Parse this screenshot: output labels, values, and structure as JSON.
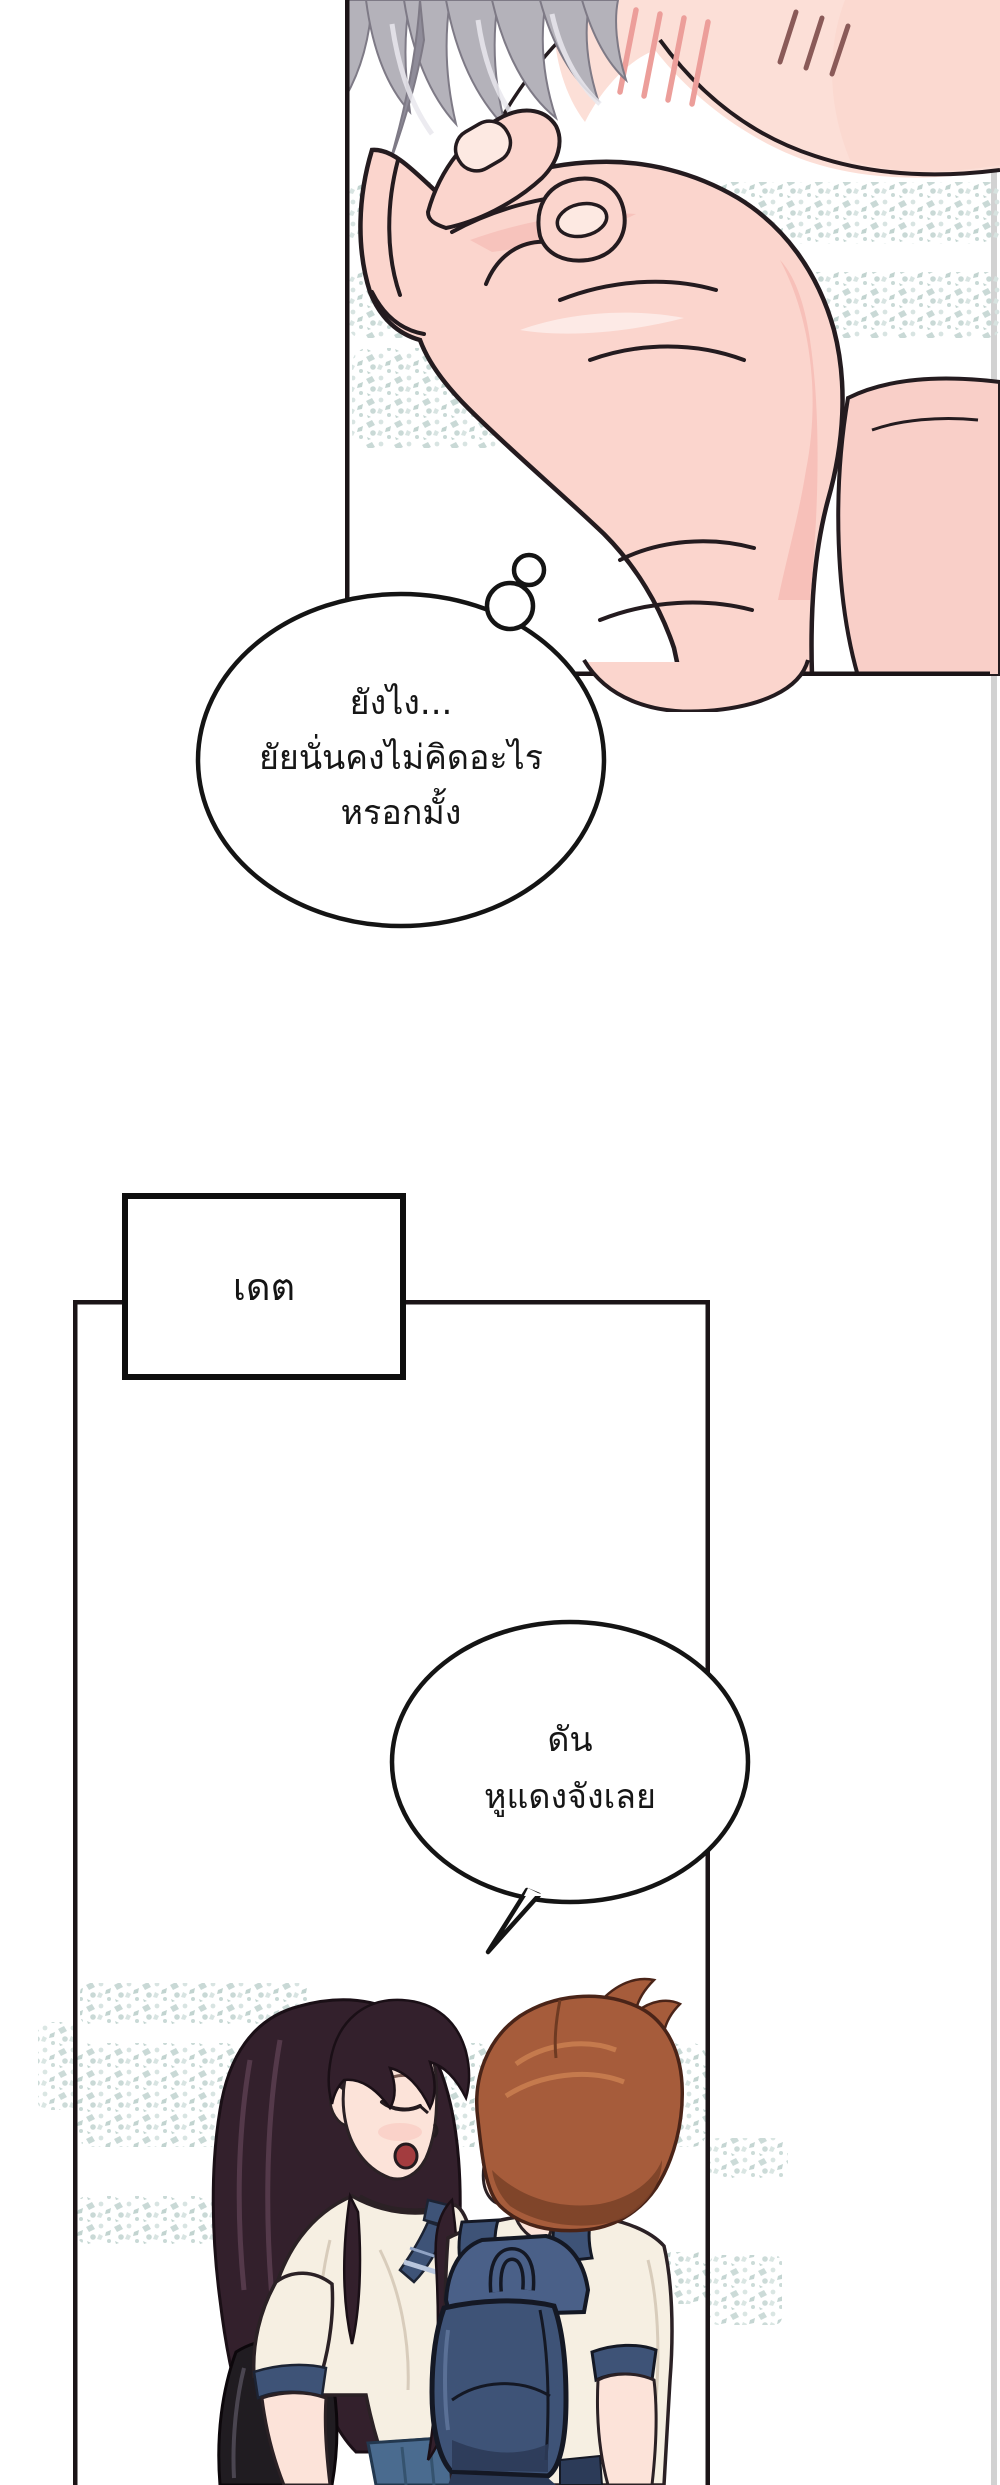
{
  "page": {
    "background": "#ffffff",
    "kind": "webtoon-comic-page"
  },
  "speech": {
    "thought_bubble": {
      "lines": [
        "ยังไง...",
        "ยัยนั่นคงไม่คิดอะไร",
        "หรอกมั้ง"
      ]
    },
    "caption_box": {
      "text": "เดต"
    },
    "speech_bubble": {
      "lines": [
        "ดัน",
        "หูแดงจังเลย"
      ]
    }
  },
  "palette": {
    "ink": "#1b1417",
    "outline": "#241b1f",
    "edge_line": "#d2d2d2",
    "skin": "#fbd5cd",
    "skin_face": "#fcdfd7",
    "skin_shadow": "#f5b8b1",
    "skin_light": "#fde9e2",
    "blush": "#ec9e9a",
    "fluster_mark": "#8a5a58",
    "hair_grey": "#b4b2ba",
    "hair_grey_dark": "#8f8c99",
    "hair_grey_light": "#e9e8ee",
    "texture_teal": "#c6d7d4",
    "texture_teal_light": "#d6e3e0",
    "texture_teal_dark": "#bfd2ce",
    "hair_dark": "#33202c",
    "hair_dark_sheen": "#5d4052",
    "hair_auburn": "#a65c3b",
    "hair_auburn_dark": "#7c4229",
    "hair_auburn_light": "#c97e50",
    "shirt_cream": "#f6efe2",
    "shirt_fold": "#d8ccbb",
    "uniform_navy": "#3e5377",
    "navy_dark": "#141824",
    "navy_deep": "#2c3b58",
    "pack_top": "#4a6088",
    "denim_blue": "#4a6b8f",
    "denim_dark": "#35536f",
    "bag_black": "#201c21",
    "mouth_red": "#a33c3f"
  }
}
